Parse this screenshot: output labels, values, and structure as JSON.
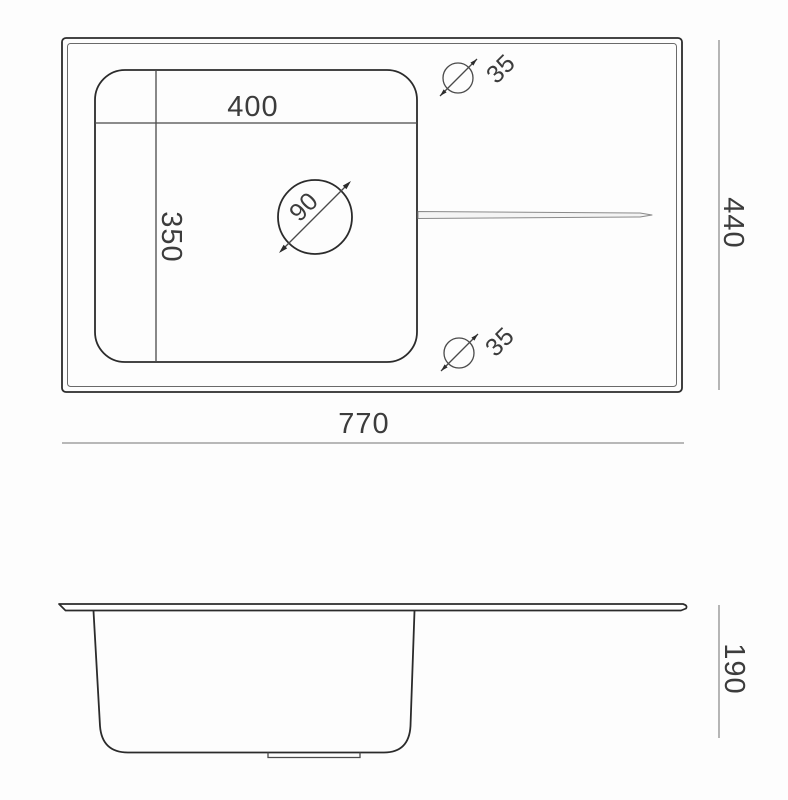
{
  "diagram": {
    "top_view": {
      "bowl_width_label": "400",
      "bowl_depth_label": "350",
      "drain_diameter_label": "90",
      "top_hole_diameter_label": "35",
      "bottom_hole_diameter_label": "35",
      "overall_width_label": "770",
      "overall_depth_label": "440"
    },
    "side_view": {
      "height_label": "190"
    },
    "colors": {
      "object_line": "#2b2b2b",
      "dimension_line": "#8f8f8f",
      "label_text": "#3c3c3c",
      "background": "#fdfdfd"
    }
  }
}
